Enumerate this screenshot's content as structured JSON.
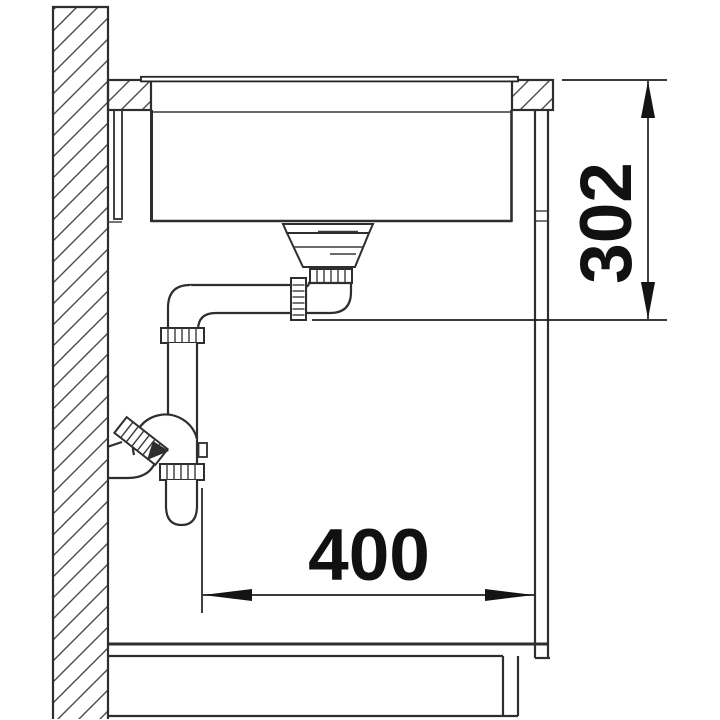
{
  "diagram": {
    "name": "sink-installation-side-section",
    "description": "technical line drawing of undermount sink with strainer, drain pipes and wall siphon in cabinet",
    "colors": {
      "background": "#ffffff",
      "line": "#2e2e2e",
      "dimension": "#141414"
    },
    "dimensions": {
      "vertical": {
        "label": "302",
        "orientation": "vertical-right"
      },
      "horizontal": {
        "label": "400",
        "orientation": "horizontal-bottom"
      }
    }
  }
}
